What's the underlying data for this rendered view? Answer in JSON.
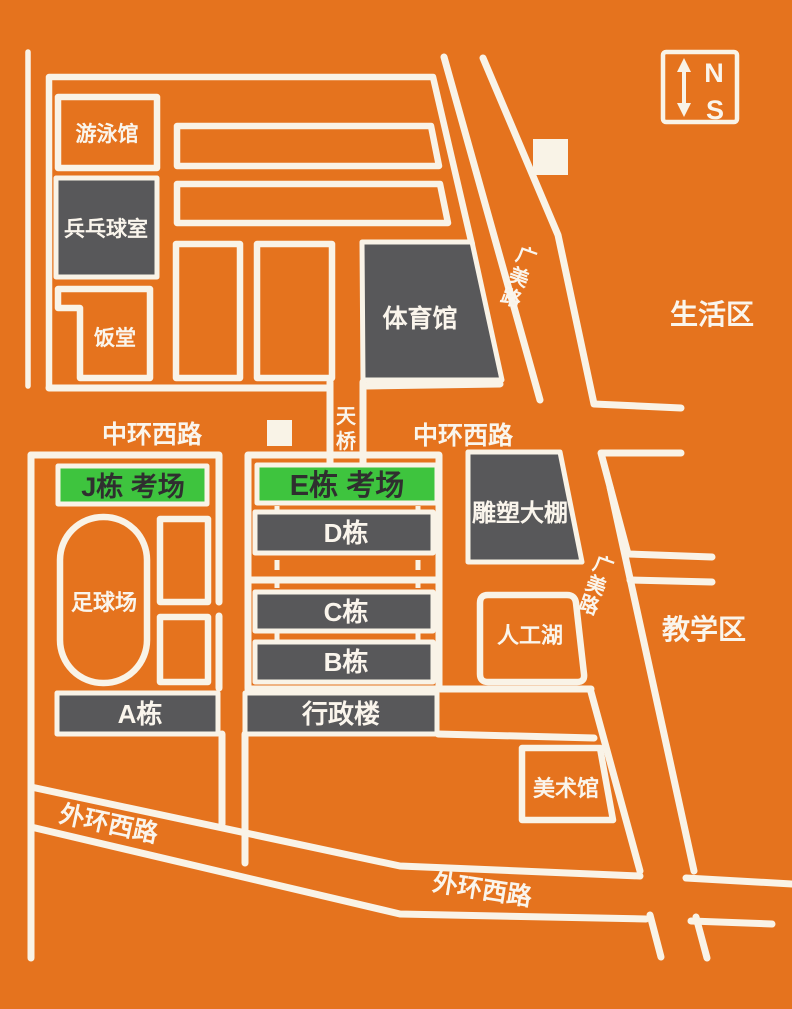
{
  "colors": {
    "background": "#E5731E",
    "road": "#F9F3E7",
    "building": "#58585A",
    "exam_green": "#3EC43E",
    "label_on_green": "#2F2F2F",
    "label_light": "#FAF5EC"
  },
  "compass": {
    "north": "N",
    "south": "S"
  },
  "areas": {
    "living": "生活区",
    "teaching": "教学区"
  },
  "roads": {
    "zhonghuan_west": "中环西路",
    "zhonghuan_east": "中环西路",
    "guangmei_north": "广美路",
    "guangmei_south": "广美路",
    "waihuan_west": "外环西路",
    "waihuan_south": "外环西路",
    "footbridge": "天桥"
  },
  "buildings": {
    "swimming_hall": "游泳馆",
    "pingpong_room": "兵乓球室",
    "canteen": "饭堂",
    "gymnasium": "体育馆",
    "sculpture_shed": "雕塑大棚",
    "artificial_lake": "人工湖",
    "art_museum": "美术馆",
    "football_field": "足球场",
    "exam_j": "J栋 考场",
    "exam_e": "E栋 考场",
    "building_d": "D栋",
    "building_c": "C栋",
    "building_b": "B栋",
    "building_a": "A栋",
    "admin_building": "行政楼"
  }
}
